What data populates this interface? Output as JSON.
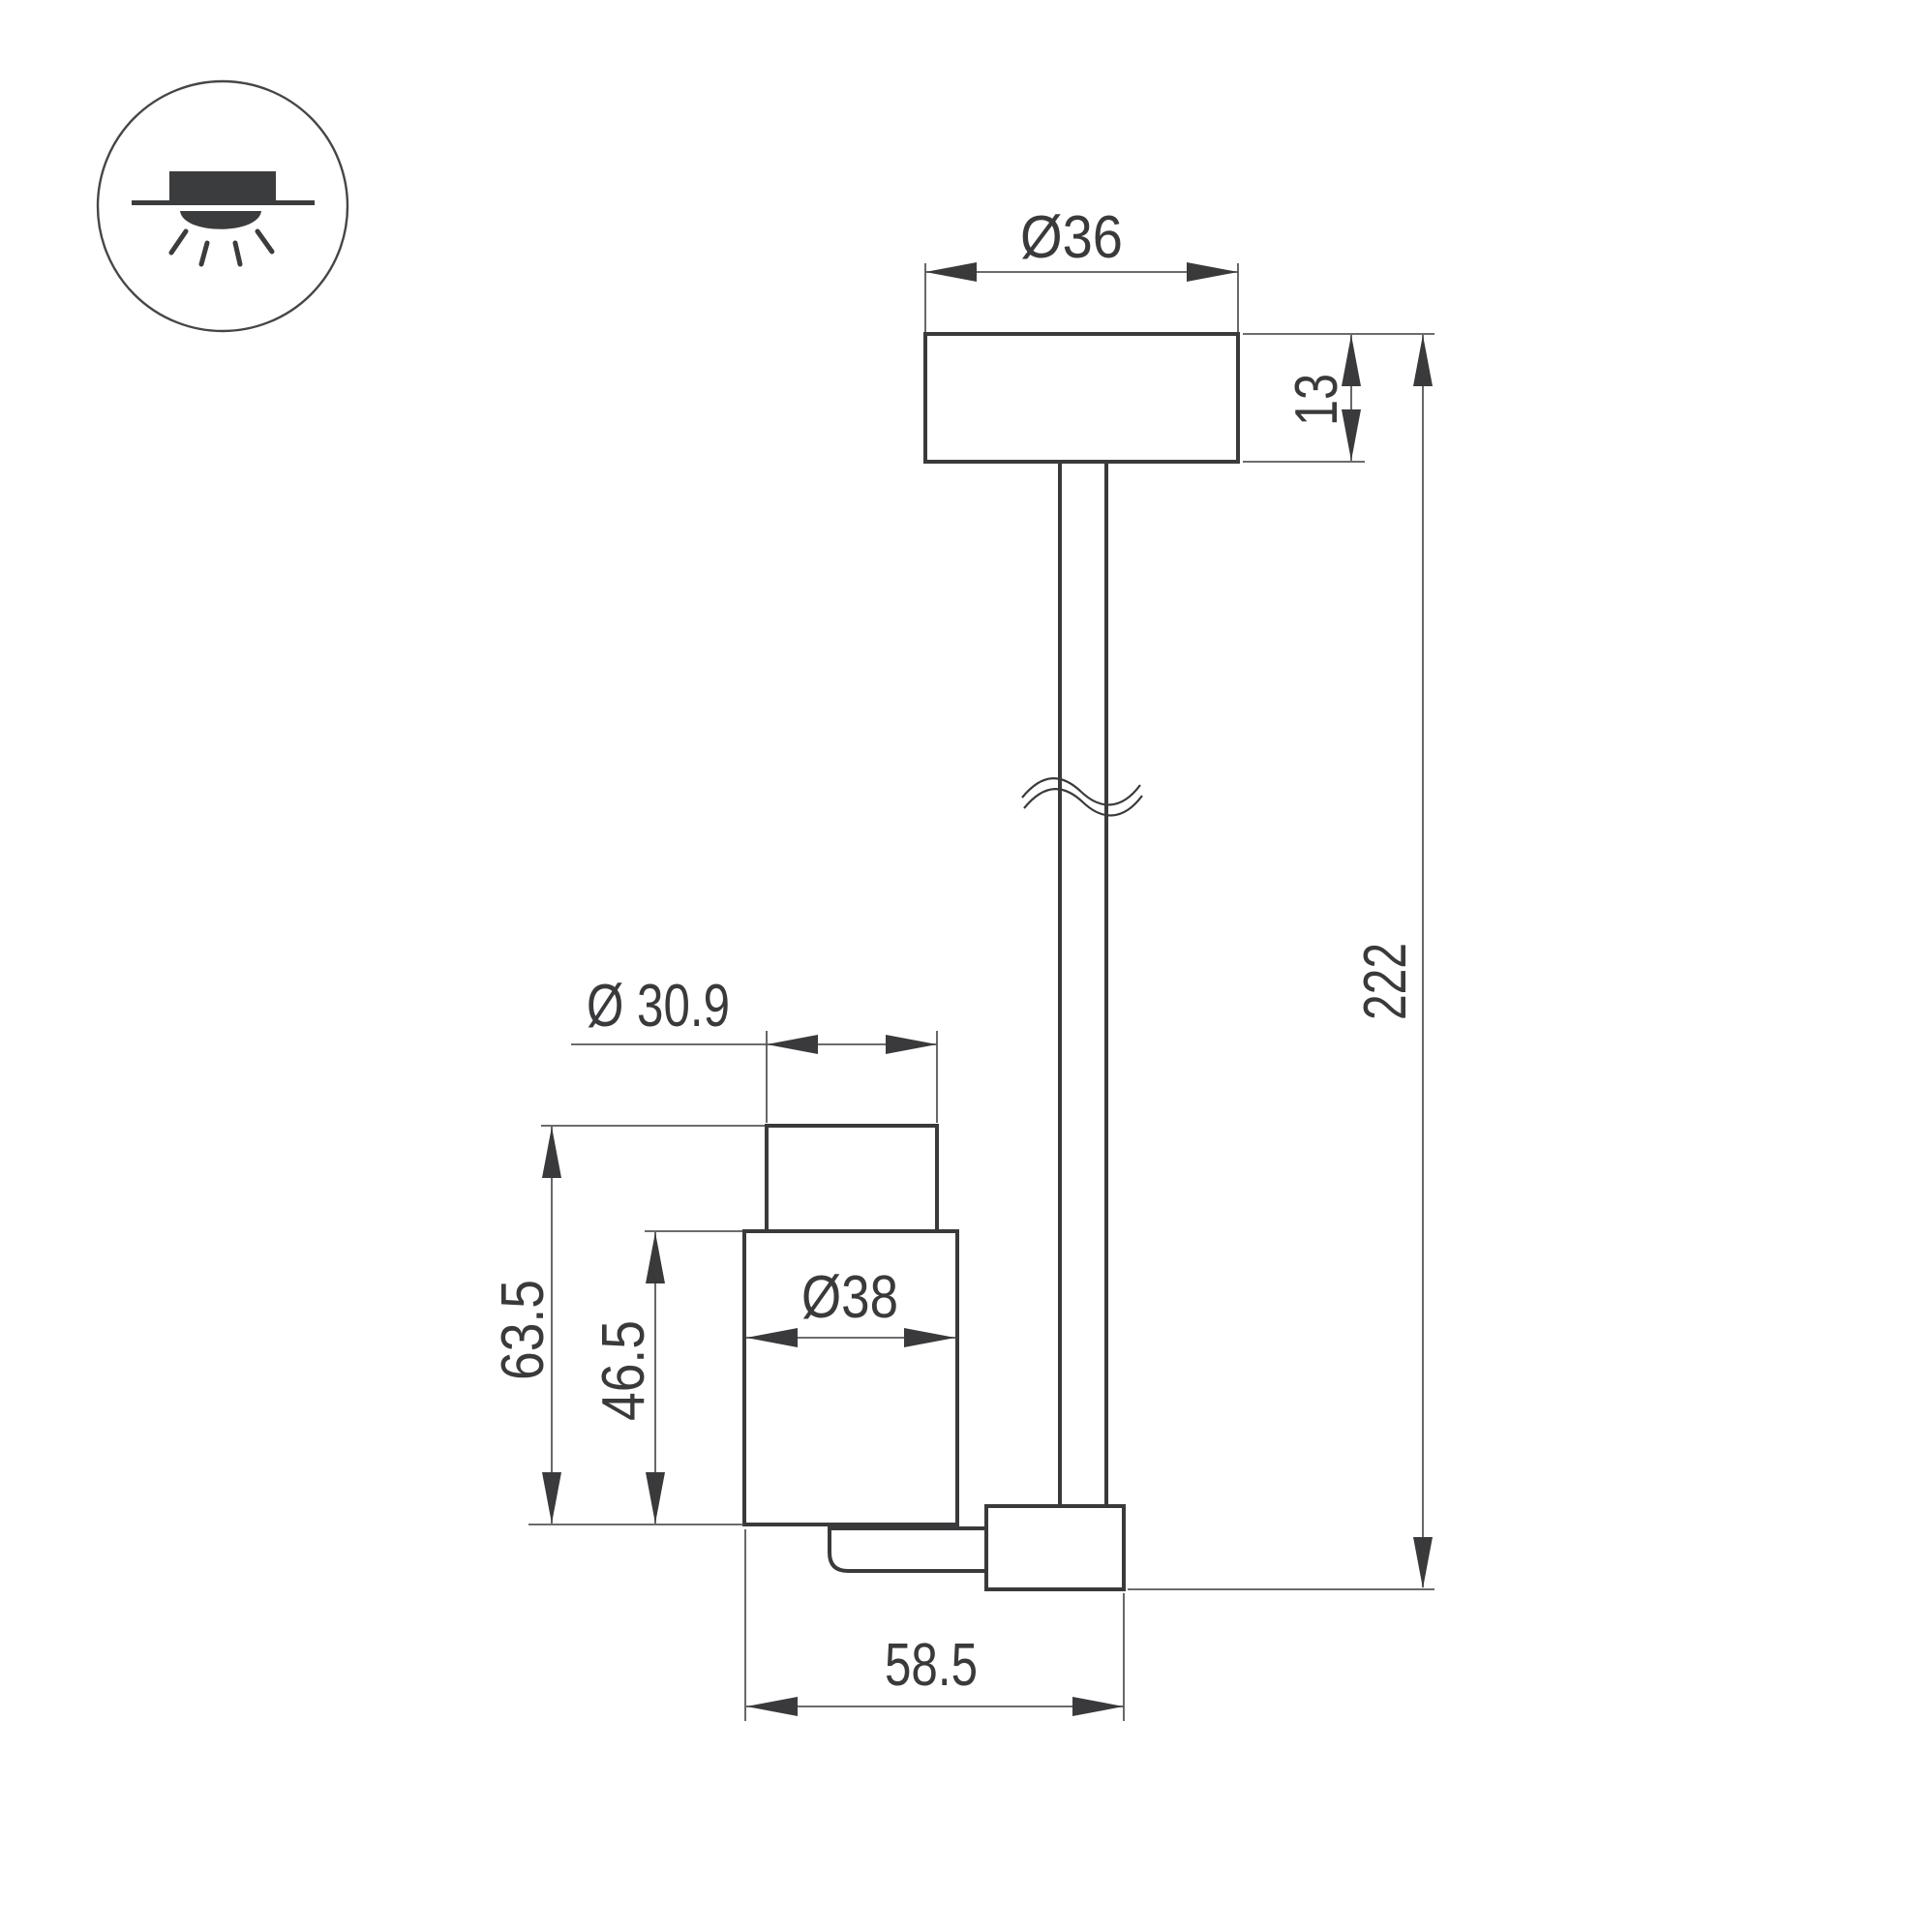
{
  "icon": {
    "name": "ceiling-surface-light-icon"
  },
  "dimensions": {
    "canopy_diameter": "Ø36",
    "canopy_height": "13",
    "overall_length": "222",
    "head_front_diameter": "Ø 30.9",
    "head_total_height": "63.5",
    "head_body_height": "46.5",
    "head_body_diameter": "Ø38",
    "head_length": "58.5"
  },
  "colors": {
    "object_line": "#3a3a3c",
    "dimension_line": "#55575a",
    "background": "#ffffff"
  }
}
